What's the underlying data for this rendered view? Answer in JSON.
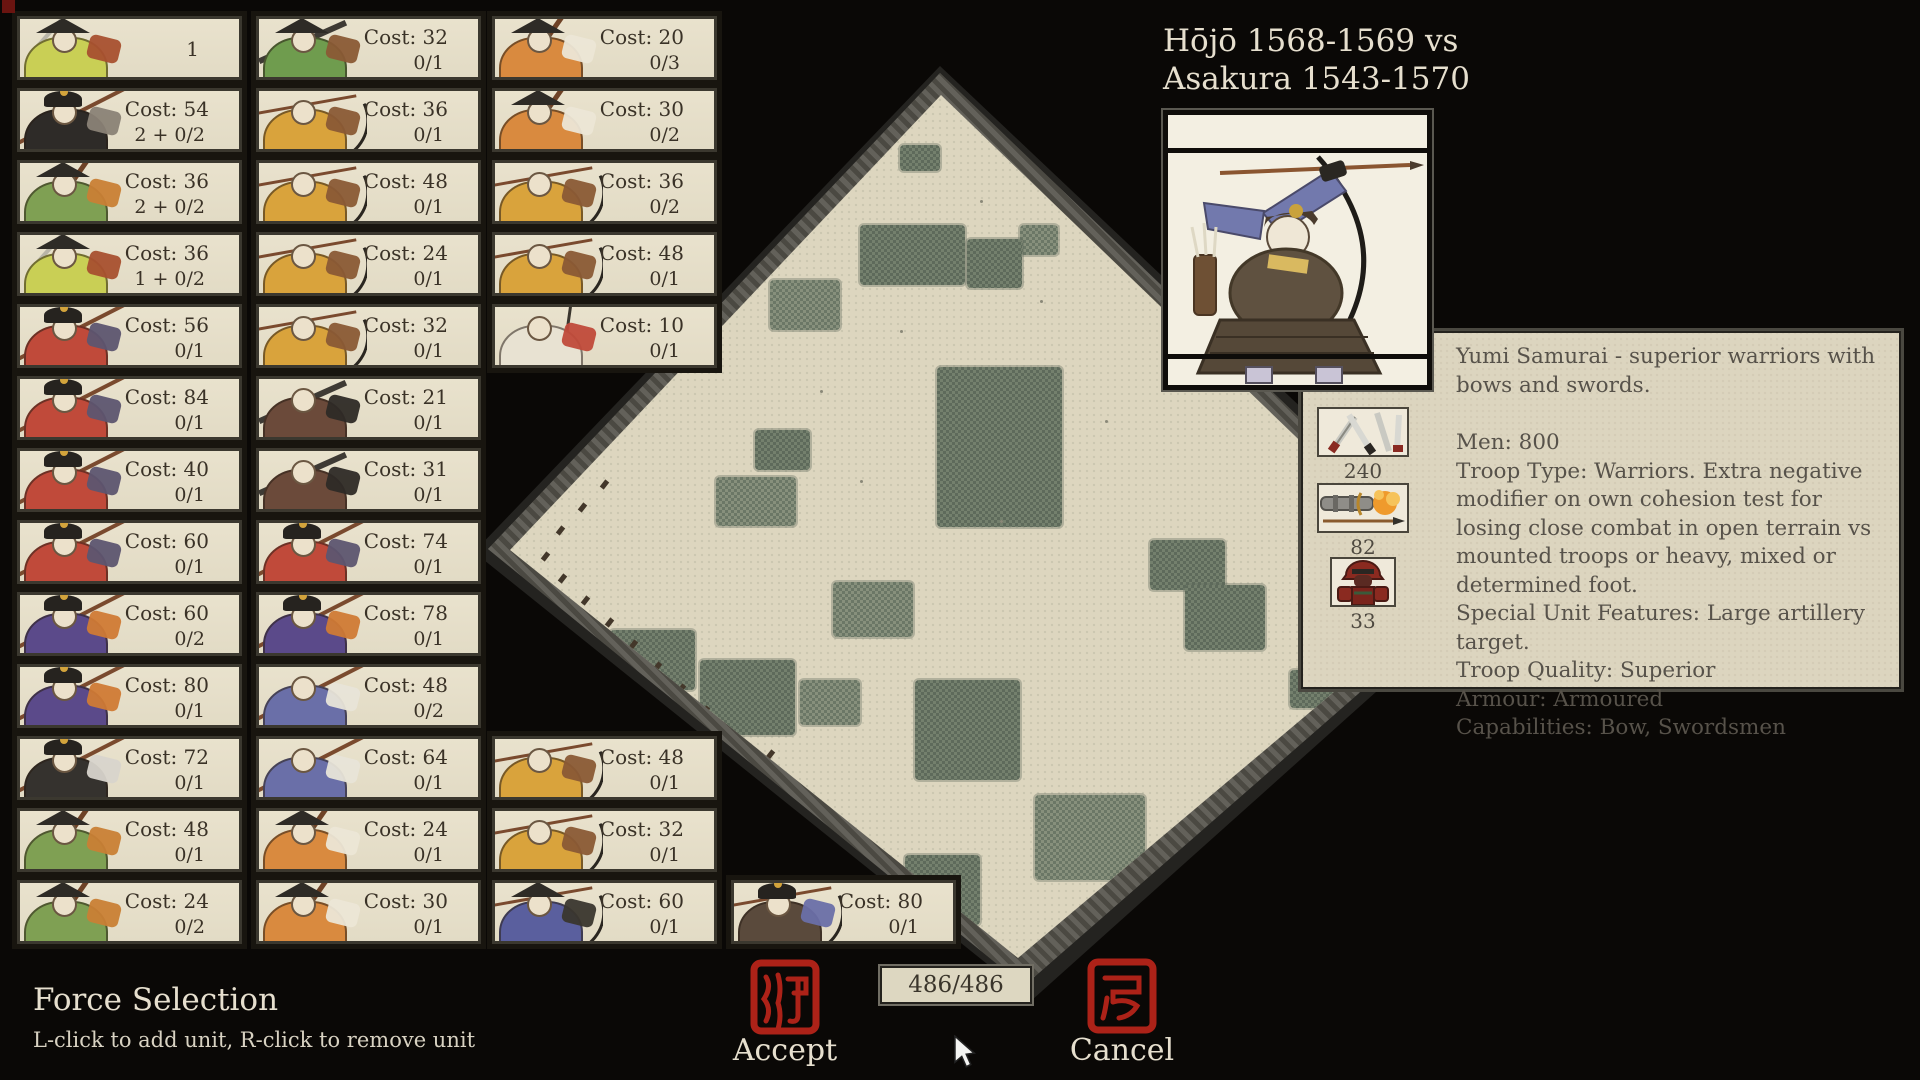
{
  "title": {
    "line1": "Hōjō 1568-1569 vs",
    "line2": "Asakura 1543-1570"
  },
  "footer": {
    "title": "Force Selection",
    "hint": "L-click to add unit, R-click to remove unit",
    "accept_label": "Accept",
    "cancel_label": "Cancel",
    "points": "486/486"
  },
  "unit_panel": {
    "description": "Yumi Samurai - superior warriors with bows and swords.",
    "stats": [
      {
        "icon": "swords-icon",
        "value": "240"
      },
      {
        "icon": "gun-icon",
        "value": "82"
      },
      {
        "icon": "armour-icon",
        "value": "33"
      }
    ],
    "info_lines": [
      "Men: 800",
      "Troop Type: Warriors. Extra negative modifier on own cohesion test for losing close combat in open terrain vs mounted troops or heavy, mixed or determined foot.",
      "Special Unit Features: Large artillery target.",
      "Troop Quality: Superior",
      "Armour: Armoured",
      "Capabilities: Bow, Swordsmen"
    ]
  },
  "force_columns": [
    {
      "cards": [
        {
          "row": 0,
          "cost": "",
          "count": "1",
          "art": "yellow-spear"
        },
        {
          "row": 1,
          "cost": "Cost: 54",
          "count": "2 + 0/2",
          "art": "black-general"
        },
        {
          "row": 2,
          "cost": "Cost: 36",
          "count": "2 + 0/2",
          "art": "green-pole"
        },
        {
          "row": 3,
          "cost": "Cost: 36",
          "count": "1 + 0/2",
          "art": "yellow-spear"
        },
        {
          "row": 4,
          "cost": "Cost: 56",
          "count": "0/1",
          "art": "red-spear"
        },
        {
          "row": 5,
          "cost": "Cost: 84",
          "count": "0/1",
          "art": "red-spear"
        },
        {
          "row": 6,
          "cost": "Cost: 40",
          "count": "0/1",
          "art": "red-spear"
        },
        {
          "row": 7,
          "cost": "Cost: 60",
          "count": "0/1",
          "art": "red-spear"
        },
        {
          "row": 8,
          "cost": "Cost: 60",
          "count": "0/2",
          "art": "purple-horse"
        },
        {
          "row": 9,
          "cost": "Cost: 80",
          "count": "0/1",
          "art": "purple-horse"
        },
        {
          "row": 10,
          "cost": "Cost: 72",
          "count": "0/1",
          "art": "black-wing"
        },
        {
          "row": 11,
          "cost": "Cost: 48",
          "count": "0/1",
          "art": "green-pole"
        },
        {
          "row": 12,
          "cost": "Cost: 24",
          "count": "0/2",
          "art": "green-pole"
        }
      ]
    },
    {
      "cards": [
        {
          "row": 0,
          "cost": "Cost: 32",
          "count": "0/1",
          "art": "green-gun"
        },
        {
          "row": 1,
          "cost": "Cost: 36",
          "count": "0/1",
          "art": "yellow-bow"
        },
        {
          "row": 2,
          "cost": "Cost: 48",
          "count": "0/1",
          "art": "yellow-bow"
        },
        {
          "row": 3,
          "cost": "Cost: 24",
          "count": "0/1",
          "art": "yellow-bow"
        },
        {
          "row": 4,
          "cost": "Cost: 32",
          "count": "0/1",
          "art": "yellow-bow"
        },
        {
          "row": 5,
          "cost": "Cost: 21",
          "count": "0/1",
          "art": "dark-gun"
        },
        {
          "row": 6,
          "cost": "Cost: 31",
          "count": "0/1",
          "art": "dark-gun"
        },
        {
          "row": 7,
          "cost": "Cost: 74",
          "count": "0/1",
          "art": "red-spear"
        },
        {
          "row": 8,
          "cost": "Cost: 78",
          "count": "0/1",
          "art": "purple-horse"
        },
        {
          "row": 9,
          "cost": "Cost: 48",
          "count": "0/2",
          "art": "blue-white"
        },
        {
          "row": 10,
          "cost": "Cost: 64",
          "count": "0/1",
          "art": "blue-white"
        },
        {
          "row": 11,
          "cost": "Cost: 24",
          "count": "0/1",
          "art": "orange-pole"
        },
        {
          "row": 12,
          "cost": "Cost: 30",
          "count": "0/1",
          "art": "orange-pole"
        }
      ]
    },
    {
      "cards": [
        {
          "row": 0,
          "cost": "Cost: 20",
          "count": "0/3",
          "art": "orange-pole"
        },
        {
          "row": 1,
          "cost": "Cost: 30",
          "count": "0/2",
          "art": "orange-pole"
        },
        {
          "row": 2,
          "cost": "Cost: 36",
          "count": "0/2",
          "art": "yellow-bow"
        },
        {
          "row": 3,
          "cost": "Cost: 48",
          "count": "0/1",
          "art": "yellow-bow"
        },
        {
          "row": 4,
          "cost": "Cost: 10",
          "count": "0/1",
          "art": "white-flag"
        },
        {
          "row": 10,
          "cost": "Cost: 48",
          "count": "0/1",
          "art": "yellow-bow"
        },
        {
          "row": 11,
          "cost": "Cost: 32",
          "count": "0/1",
          "art": "yellow-bow"
        },
        {
          "row": 12,
          "cost": "Cost: 60",
          "count": "0/1",
          "art": "blue-bow"
        }
      ]
    },
    {
      "cards": [
        {
          "row": 12,
          "cost": "Cost: 80",
          "count": "0/1",
          "art": "dark-bow"
        }
      ]
    }
  ],
  "art_palette": {
    "yellow-spear": {
      "body": "#c9cf55",
      "accent": "#a8502f",
      "weapon": "sword",
      "hat": "hat"
    },
    "black-general": {
      "body": "#2e2b28",
      "accent": "#8a8276",
      "weapon": "spear",
      "hat": "helm"
    },
    "green-pole": {
      "body": "#7fa053",
      "accent": "#c97f35",
      "weapon": "pole",
      "hat": "hat"
    },
    "red-spear": {
      "body": "#c04a3a",
      "accent": "#5d5570",
      "weapon": "spear",
      "hat": "helm"
    },
    "purple-horse": {
      "body": "#5b4a8a",
      "accent": "#d07a35",
      "weapon": "spear",
      "hat": "helm"
    },
    "black-wing": {
      "body": "#35322e",
      "accent": "#d8d4cc",
      "weapon": "spear",
      "hat": "helm"
    },
    "green-gun": {
      "body": "#6f9c4e",
      "accent": "#8a5a35",
      "weapon": "gun",
      "hat": "hat"
    },
    "yellow-bow": {
      "body": "#d9a33c",
      "accent": "#8a5a35",
      "weapon": "bow",
      "hat": "none"
    },
    "dark-gun": {
      "body": "#6b4a3a",
      "accent": "#2e2a26",
      "weapon": "gun",
      "hat": "none"
    },
    "blue-white": {
      "body": "#6a6fa8",
      "accent": "#e8e4d8",
      "weapon": "spear",
      "hat": "none"
    },
    "orange-pole": {
      "body": "#d98a3f",
      "accent": "#ece6d6",
      "weapon": "pole",
      "hat": "hat"
    },
    "white-flag": {
      "body": "#e8e2d2",
      "accent": "#c04a3a",
      "weapon": "flag",
      "hat": "none"
    },
    "blue-bow": {
      "body": "#5a5f9e",
      "accent": "#3a362e",
      "weapon": "bow",
      "hat": "hat"
    },
    "dark-bow": {
      "body": "#5a4a3c",
      "accent": "#6a6fa8",
      "weapon": "bow",
      "hat": "helm"
    }
  },
  "map": {
    "patches": [
      {
        "x": 900,
        "y": 145,
        "w": 40,
        "h": 26
      },
      {
        "x": 1020,
        "y": 225,
        "w": 38,
        "h": 30
      },
      {
        "x": 860,
        "y": 225,
        "w": 105,
        "h": 60
      },
      {
        "x": 967,
        "y": 239,
        "w": 55,
        "h": 49
      },
      {
        "x": 770,
        "y": 280,
        "w": 70,
        "h": 50
      },
      {
        "x": 937,
        "y": 367,
        "w": 125,
        "h": 160
      },
      {
        "x": 755,
        "y": 430,
        "w": 55,
        "h": 40
      },
      {
        "x": 716,
        "y": 477,
        "w": 80,
        "h": 49
      },
      {
        "x": 1150,
        "y": 540,
        "w": 75,
        "h": 50
      },
      {
        "x": 1185,
        "y": 585,
        "w": 80,
        "h": 65
      },
      {
        "x": 833,
        "y": 582,
        "w": 80,
        "h": 55
      },
      {
        "x": 610,
        "y": 630,
        "w": 85,
        "h": 60
      },
      {
        "x": 700,
        "y": 660,
        "w": 95,
        "h": 75
      },
      {
        "x": 800,
        "y": 680,
        "w": 60,
        "h": 45
      },
      {
        "x": 915,
        "y": 680,
        "w": 105,
        "h": 100
      },
      {
        "x": 1290,
        "y": 670,
        "w": 62,
        "h": 38
      },
      {
        "x": 1035,
        "y": 795,
        "w": 110,
        "h": 85
      },
      {
        "x": 905,
        "y": 855,
        "w": 75,
        "h": 70
      }
    ],
    "troops": [
      {
        "x": 602,
        "y": 480
      },
      {
        "x": 580,
        "y": 503
      },
      {
        "x": 558,
        "y": 526
      },
      {
        "x": 543,
        "y": 552
      },
      {
        "x": 560,
        "y": 574
      },
      {
        "x": 583,
        "y": 596
      },
      {
        "x": 607,
        "y": 618
      },
      {
        "x": 631,
        "y": 640
      },
      {
        "x": 655,
        "y": 662
      },
      {
        "x": 679,
        "y": 684
      },
      {
        "x": 703,
        "y": 706
      },
      {
        "x": 727,
        "y": 728
      },
      {
        "x": 768,
        "y": 750
      }
    ],
    "dots": [
      {
        "x": 980,
        "y": 200
      },
      {
        "x": 1040,
        "y": 300
      },
      {
        "x": 900,
        "y": 330
      },
      {
        "x": 1105,
        "y": 420
      },
      {
        "x": 860,
        "y": 480
      },
      {
        "x": 1000,
        "y": 520
      },
      {
        "x": 1120,
        "y": 250
      },
      {
        "x": 820,
        "y": 390
      }
    ]
  },
  "colors": {
    "background": "#0a0806",
    "parchment": "#e6dfca",
    "panel": "#dcd5bf",
    "seal_red": "#ac2218",
    "map_tan": "#ddd6bf",
    "patch_green": "#727e6f",
    "text_dark": "#3a3227",
    "text_cream": "#e6dfce"
  }
}
